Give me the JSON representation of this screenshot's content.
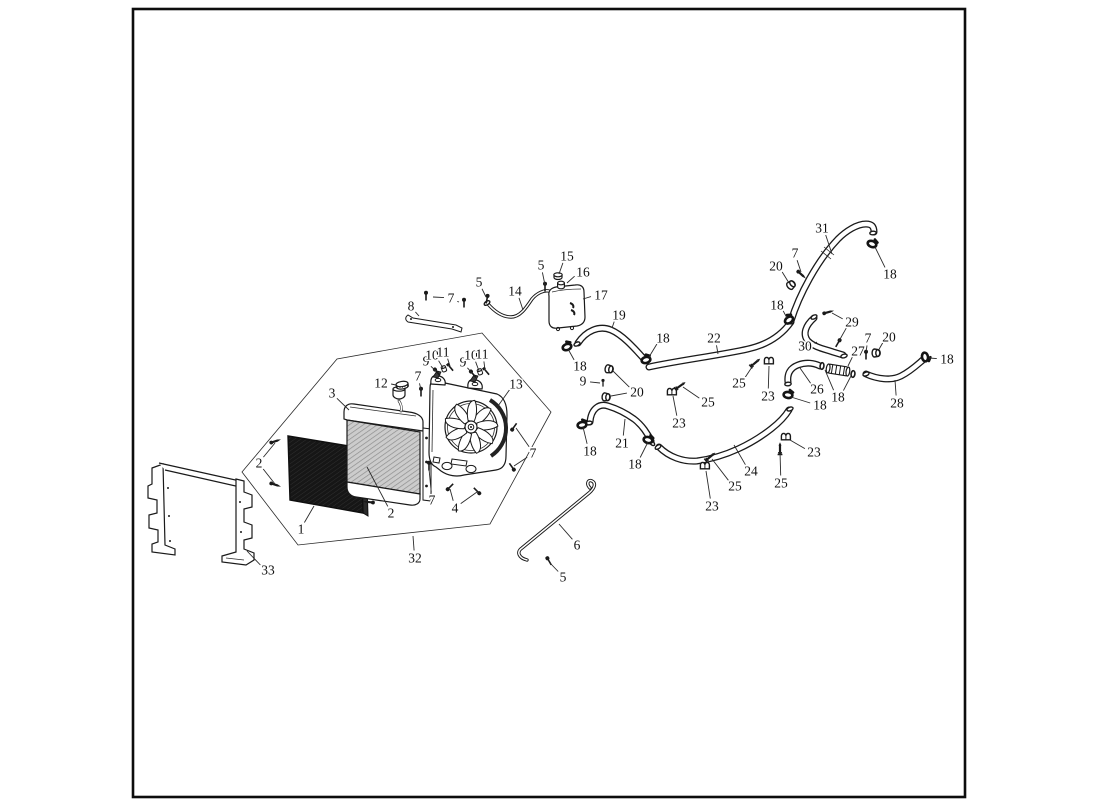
{
  "page": {
    "background": "#ffffff",
    "frame_color": "#0d0d0d"
  },
  "callouts": [
    {
      "label": "1",
      "x": 301,
      "y": 529,
      "leaders": [
        [
          314,
          506
        ]
      ]
    },
    {
      "label": "2",
      "x": 259,
      "y": 463,
      "leaders": [
        [
          275,
          443
        ],
        [
          275,
          484
        ]
      ]
    },
    {
      "label": "2",
      "x": 391,
      "y": 513,
      "leaders": [
        [
          367,
          467
        ]
      ]
    },
    {
      "label": "3",
      "x": 332,
      "y": 393,
      "leaders": [
        [
          349,
          410
        ]
      ]
    },
    {
      "label": "4",
      "x": 455,
      "y": 508,
      "leaders": [
        [
          450,
          489
        ],
        [
          477,
          492
        ]
      ]
    },
    {
      "label": "5",
      "x": 479,
      "y": 282,
      "leaders": [
        [
          486,
          297
        ]
      ]
    },
    {
      "label": "5",
      "x": 541,
      "y": 265,
      "leaders": [
        [
          545,
          285
        ]
      ]
    },
    {
      "label": "5",
      "x": 563,
      "y": 577,
      "leaders": [
        [
          550,
          563
        ]
      ]
    },
    {
      "label": "6",
      "x": 577,
      "y": 545,
      "leaders": [
        [
          559,
          524
        ]
      ]
    },
    {
      "label": "7",
      "x": 451,
      "y": 298,
      "leaders": [
        [
          433,
          297
        ],
        [
          459,
          302
        ]
      ]
    },
    {
      "label": "7",
      "x": 418,
      "y": 376,
      "leaders": [
        [
          421,
          390
        ]
      ]
    },
    {
      "label": "7",
      "x": 533,
      "y": 453,
      "leaders": [
        [
          516,
          428
        ],
        [
          514,
          466
        ]
      ]
    },
    {
      "label": "7",
      "x": 432,
      "y": 500,
      "leaders": [
        [
          429,
          469
        ]
      ]
    },
    {
      "label": "7",
      "x": 795,
      "y": 253,
      "leaders": [
        [
          801,
          272
        ]
      ]
    },
    {
      "label": "7",
      "x": 868,
      "y": 338,
      "leaders": [
        [
          866,
          352
        ]
      ]
    },
    {
      "label": "8",
      "x": 411,
      "y": 306,
      "leaders": [
        [
          419,
          316
        ]
      ]
    },
    {
      "label": "9",
      "x": 426,
      "y": 361,
      "leaders": [
        [
          436,
          371
        ]
      ]
    },
    {
      "label": "10",
      "x": 432,
      "y": 355,
      "leaders": [
        [
          443,
          368
        ]
      ]
    },
    {
      "label": "11",
      "x": 443,
      "y": 352,
      "leaders": [
        [
          450,
          366
        ]
      ]
    },
    {
      "label": "9",
      "x": 463,
      "y": 362,
      "leaders": [
        [
          472,
          373
        ]
      ]
    },
    {
      "label": "10",
      "x": 471,
      "y": 355,
      "leaders": [
        [
          479,
          371
        ]
      ]
    },
    {
      "label": "11",
      "x": 482,
      "y": 354,
      "leaders": [
        [
          485,
          370
        ]
      ]
    },
    {
      "label": "9",
      "x": 583,
      "y": 381,
      "leaders": [
        [
          600,
          383
        ]
      ]
    },
    {
      "label": "12",
      "x": 381,
      "y": 383,
      "leaders": [
        [
          396,
          385
        ]
      ]
    },
    {
      "label": "13",
      "x": 516,
      "y": 384,
      "leaders": [
        [
          498,
          406
        ]
      ]
    },
    {
      "label": "14",
      "x": 515,
      "y": 291,
      "leaders": [
        [
          523,
          310
        ]
      ]
    },
    {
      "label": "15",
      "x": 567,
      "y": 256,
      "leaders": [
        [
          559,
          274
        ]
      ]
    },
    {
      "label": "16",
      "x": 583,
      "y": 272,
      "leaders": [
        [
          567,
          283
        ]
      ]
    },
    {
      "label": "17",
      "x": 601,
      "y": 295,
      "leaders": [
        [
          583,
          299
        ]
      ]
    },
    {
      "label": "18",
      "x": 580,
      "y": 366,
      "leaders": [
        [
          568,
          349
        ]
      ]
    },
    {
      "label": "18",
      "x": 663,
      "y": 338,
      "leaders": [
        [
          649,
          357
        ]
      ]
    },
    {
      "label": "18",
      "x": 590,
      "y": 451,
      "leaders": [
        [
          583,
          427
        ]
      ]
    },
    {
      "label": "18",
      "x": 635,
      "y": 464,
      "leaders": [
        [
          648,
          442
        ]
      ]
    },
    {
      "label": "18",
      "x": 820,
      "y": 405,
      "leaders": [
        [
          791,
          397
        ]
      ]
    },
    {
      "label": "18",
      "x": 838,
      "y": 397,
      "leaders": [
        [
          825,
          370
        ],
        [
          851,
          376
        ]
      ]
    },
    {
      "label": "18",
      "x": 777,
      "y": 305,
      "leaders": [
        [
          787,
          318
        ]
      ]
    },
    {
      "label": "18",
      "x": 890,
      "y": 274,
      "leaders": [
        [
          875,
          247
        ]
      ]
    },
    {
      "label": "18",
      "x": 947,
      "y": 359,
      "leaders": [
        [
          929,
          358
        ]
      ]
    },
    {
      "label": "19",
      "x": 619,
      "y": 315,
      "leaders": [
        [
          612,
          328
        ]
      ]
    },
    {
      "label": "20",
      "x": 637,
      "y": 392,
      "leaders": [
        [
          613,
          371
        ],
        [
          611,
          396
        ]
      ]
    },
    {
      "label": "20",
      "x": 776,
      "y": 266,
      "leaders": [
        [
          789,
          283
        ]
      ]
    },
    {
      "label": "20",
      "x": 889,
      "y": 337,
      "leaders": [
        [
          878,
          351
        ]
      ]
    },
    {
      "label": "21",
      "x": 622,
      "y": 443,
      "leaders": [
        [
          625,
          419
        ]
      ]
    },
    {
      "label": "22",
      "x": 714,
      "y": 338,
      "leaders": [
        [
          718,
          354
        ]
      ]
    },
    {
      "label": "23",
      "x": 768,
      "y": 396,
      "leaders": [
        [
          769,
          366
        ]
      ]
    },
    {
      "label": "23",
      "x": 679,
      "y": 423,
      "leaders": [
        [
          673,
          396
        ]
      ]
    },
    {
      "label": "23",
      "x": 712,
      "y": 506,
      "leaders": [
        [
          706,
          471
        ]
      ]
    },
    {
      "label": "23",
      "x": 814,
      "y": 452,
      "leaders": [
        [
          790,
          440
        ]
      ]
    },
    {
      "label": "24",
      "x": 751,
      "y": 471,
      "leaders": [
        [
          734,
          445
        ]
      ]
    },
    {
      "label": "25",
      "x": 739,
      "y": 383,
      "leaders": [
        [
          754,
          364
        ]
      ]
    },
    {
      "label": "25",
      "x": 708,
      "y": 402,
      "leaders": [
        [
          683,
          387
        ]
      ]
    },
    {
      "label": "25",
      "x": 735,
      "y": 486,
      "leaders": [
        [
          712,
          459
        ]
      ]
    },
    {
      "label": "25",
      "x": 781,
      "y": 483,
      "leaders": [
        [
          780,
          452
        ]
      ]
    },
    {
      "label": "26",
      "x": 817,
      "y": 389,
      "leaders": [
        [
          800,
          368
        ]
      ]
    },
    {
      "label": "27",
      "x": 858,
      "y": 351,
      "leaders": [
        [
          848,
          366
        ]
      ]
    },
    {
      "label": "28",
      "x": 897,
      "y": 403,
      "leaders": [
        [
          895,
          380
        ]
      ]
    },
    {
      "label": "29",
      "x": 852,
      "y": 322,
      "leaders": [
        [
          832,
          313
        ],
        [
          839,
          341
        ]
      ]
    },
    {
      "label": "30",
      "x": 805,
      "y": 346,
      "leaders": [
        [
          817,
          342
        ]
      ]
    },
    {
      "label": "31",
      "x": 822,
      "y": 228,
      "leaders": [
        [
          832,
          254
        ]
      ]
    },
    {
      "label": "32",
      "x": 415,
      "y": 558,
      "leaders": [
        [
          413,
          536
        ]
      ]
    },
    {
      "label": "33",
      "x": 268,
      "y": 570,
      "leaders": [
        [
          247,
          551
        ]
      ]
    }
  ]
}
